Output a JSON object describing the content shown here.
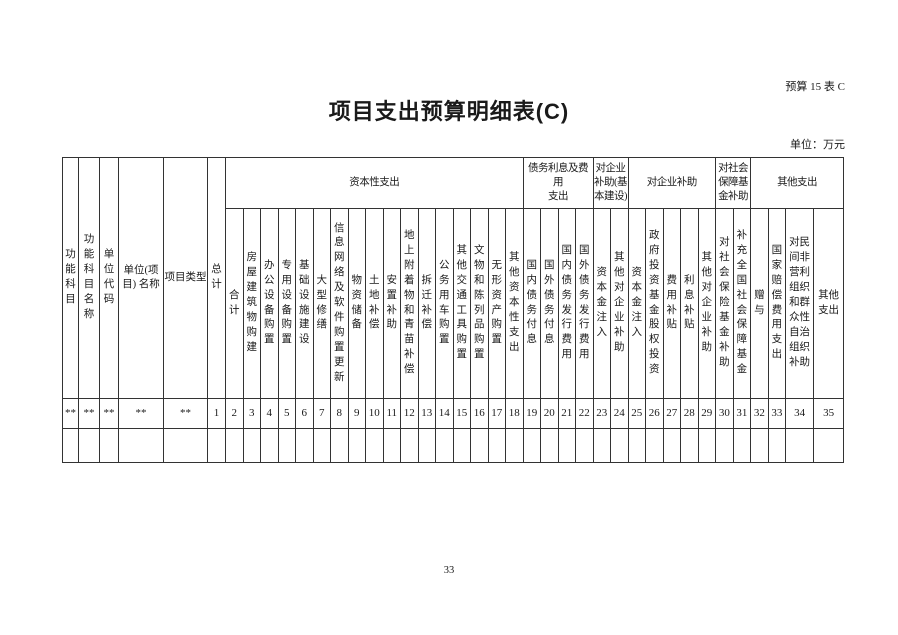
{
  "page": {
    "doc_code": "预算 15 表 C",
    "title": "项目支出预算明细表(C)",
    "unit_label": "单位：万元",
    "page_number": "33"
  },
  "table": {
    "fixed_columns": [
      {
        "label": "功能科目",
        "code": "**"
      },
      {
        "label": "功能科目名称",
        "code": "**"
      },
      {
        "label": "单位代码",
        "code": "**"
      },
      {
        "label": "单位(项\n目) 名称",
        "code": "**"
      },
      {
        "label": "项目类型",
        "code": "**"
      },
      {
        "label": "总计",
        "code": "1"
      }
    ],
    "groups": [
      {
        "label": "资本性支出",
        "span": 17
      },
      {
        "label": "债务利息及费用\n支出",
        "span": 4
      },
      {
        "label": "对企业\n补助(基\n本建设)",
        "span": 2
      },
      {
        "label": "对企业补助",
        "span": 5
      },
      {
        "label": "对社会\n保障基\n金补助",
        "span": 2
      },
      {
        "label": "其他支出",
        "span": 4
      }
    ],
    "sub_columns": [
      {
        "label": "合计",
        "code": "2"
      },
      {
        "label": "房屋建筑物购建",
        "code": "3"
      },
      {
        "label": "办公设备购置",
        "code": "4"
      },
      {
        "label": "专用设备购置",
        "code": "5"
      },
      {
        "label": "基础设施建设",
        "code": "6"
      },
      {
        "label": "大型修缮",
        "code": "7"
      },
      {
        "label": "信息网络及软件购置更新",
        "code": "8"
      },
      {
        "label": "物资储备",
        "code": "9"
      },
      {
        "label": "土地补偿",
        "code": "10"
      },
      {
        "label": "安置补助",
        "code": "11"
      },
      {
        "label": "地上附着物和青苗补偿",
        "code": "12"
      },
      {
        "label": "拆迁补偿",
        "code": "13"
      },
      {
        "label": "公务用车购置",
        "code": "14"
      },
      {
        "label": "其他交通工具购置",
        "code": "15"
      },
      {
        "label": "文物和陈列品购置",
        "code": "16"
      },
      {
        "label": "无形资产购置",
        "code": "17"
      },
      {
        "label": "其他资本性支出",
        "code": "18"
      },
      {
        "label": "国内债务付息",
        "code": "19"
      },
      {
        "label": "国外债务付息",
        "code": "20"
      },
      {
        "label": "国内债务发行费用",
        "code": "21"
      },
      {
        "label": "国外债务发行费用",
        "code": "22"
      },
      {
        "label": "资本金注入",
        "code": "23"
      },
      {
        "label": "其他对企业补助",
        "code": "24"
      },
      {
        "label": "资本金注入",
        "code": "25"
      },
      {
        "label": "政府投资基金股权投资",
        "code": "26"
      },
      {
        "label": "费用补贴",
        "code": "27"
      },
      {
        "label": "利息补贴",
        "code": "28"
      },
      {
        "label": "其他对企业补助",
        "code": "29"
      },
      {
        "label": "对社会保险基金补助",
        "code": "30"
      },
      {
        "label": "补充全国社会保障基金",
        "code": "31"
      },
      {
        "label": "赠与",
        "code": "32"
      },
      {
        "label": "国家赔偿费用支出",
        "code": "33"
      },
      {
        "label": "对民间非营利组织和群众性自治组织补助",
        "code": "34"
      },
      {
        "label": "其他支出",
        "code": "35"
      }
    ]
  }
}
